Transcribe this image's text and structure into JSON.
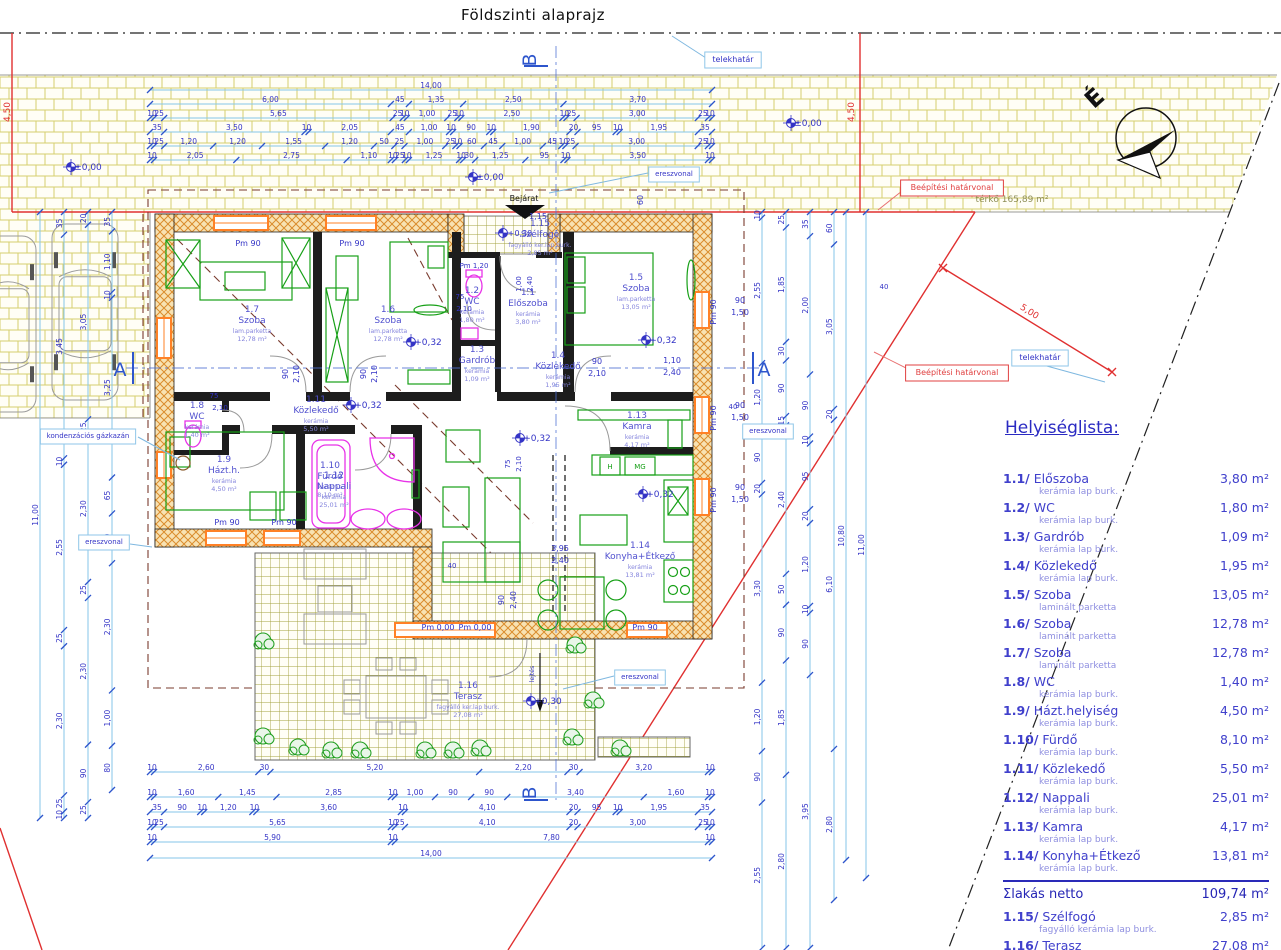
{
  "title": "Földszinti alaprajz",
  "north_label": "É",
  "room_list": {
    "title": "Helyiséglista:",
    "items": [
      {
        "num": "1.1/",
        "name": "Előszoba",
        "area": "3,80 m²",
        "finish": "kerámia lap burk."
      },
      {
        "num": "1.2/",
        "name": "WC",
        "area": "1,80 m²",
        "finish": "kerámia lap burk."
      },
      {
        "num": "1.3/",
        "name": "Gardrób",
        "area": "1,09 m²",
        "finish": "kerámia lap burk."
      },
      {
        "num": "1.4/",
        "name": "Közlekedő",
        "area": "1,95 m²",
        "finish": "kerámia lap burk."
      },
      {
        "num": "1.5/",
        "name": "Szoba",
        "area": "13,05 m²",
        "finish": "laminált parketta"
      },
      {
        "num": "1.6/",
        "name": "Szoba",
        "area": "12,78 m²",
        "finish": "laminált parketta"
      },
      {
        "num": "1.7/",
        "name": "Szoba",
        "area": "12,78 m²",
        "finish": "laminált parketta"
      },
      {
        "num": "1.8/",
        "name": "WC",
        "area": "1,40 m²",
        "finish": "kerámia lap burk."
      },
      {
        "num": "1.9/",
        "name": "Házt.helyiség",
        "area": "4,50 m²",
        "finish": "kerámia lap burk."
      },
      {
        "num": "1.10/",
        "name": "Fürdő",
        "area": "8,10 m²",
        "finish": "kerámia lap burk."
      },
      {
        "num": "1.11/",
        "name": "Közlekedő",
        "area": "5,50 m²",
        "finish": "kerámia lap burk."
      },
      {
        "num": "1.12/",
        "name": "Nappali",
        "area": "25,01 m²",
        "finish": "kerámia lap burk."
      },
      {
        "num": "1.13/",
        "name": "Kamra",
        "area": "4,17 m²",
        "finish": "kerámia lap burk."
      },
      {
        "num": "1.14/",
        "name": "Konyha+Étkező",
        "area": "13,81 m²",
        "finish": "kerámia lap burk."
      }
    ],
    "total": {
      "label": "Σlakás netto",
      "area": "109,74 m²"
    },
    "extra_items": [
      {
        "num": "1.15/",
        "name": "Szélfogó",
        "area": "2,85 m²",
        "finish": "fagyálló kerámia lap burk."
      },
      {
        "num": "1.16/",
        "name": "Terasz",
        "area": "27,08 m²",
        "finish": "fagyálló kerámia lap burk."
      }
    ]
  },
  "rooms": [
    {
      "num": "1.7",
      "name": "Szoba",
      "finish": "lam.parketta",
      "area": "12,78 m²",
      "x": 252,
      "y": 312
    },
    {
      "num": "1.6",
      "name": "Szoba",
      "finish": "lam.parketta",
      "area": "12,78 m²",
      "x": 388,
      "y": 312
    },
    {
      "num": "1.5",
      "name": "Szoba",
      "finish": "lam.parketta",
      "area": "13,05 m²",
      "x": 636,
      "y": 280
    },
    {
      "num": "1.1",
      "name": "Előszoba",
      "finish": "kerámia",
      "area": "3,80 m²",
      "x": 528,
      "y": 295
    },
    {
      "num": "1.2",
      "name": "WC",
      "finish": "kerámia",
      "area": "1,80 m²",
      "x": 472,
      "y": 293
    },
    {
      "num": "1.3",
      "name": "Gardrób",
      "finish": "kerámia",
      "area": "1,09 m²",
      "x": 477,
      "y": 352
    },
    {
      "num": "1.4",
      "name": "Közlekedő",
      "finish": "kerámia",
      "area": "1,95 m²",
      "x": 558,
      "y": 358
    },
    {
      "num": "1.11",
      "name": "Közlekedő",
      "finish": "kerámia",
      "area": "5,50 m²",
      "x": 316,
      "y": 402
    },
    {
      "num": "1.8",
      "name": "WC",
      "finish": "kerámia",
      "area": "1,40 m²",
      "x": 197,
      "y": 408
    },
    {
      "num": "1.9",
      "name": "Házt.h.",
      "finish": "kerámia",
      "area": "4,50 m²",
      "x": 224,
      "y": 462
    },
    {
      "num": "1.10",
      "name": "Fürdő",
      "finish": "kerámia",
      "area": "8,10 m²",
      "x": 330,
      "y": 468
    },
    {
      "num": "1.12",
      "name": "Nappali",
      "finish": "kerámia",
      "area": "25,01 m²",
      "x": 334,
      "y": 478
    },
    {
      "num": "1.13",
      "name": "Kamra",
      "finish": "kerámia",
      "area": "4,17 m²",
      "x": 637,
      "y": 418
    },
    {
      "num": "1.14",
      "name": "Konyha+Étkező",
      "finish": "kerámia",
      "area": "13,81 m²",
      "x": 640,
      "y": 548
    },
    {
      "num": "1.15",
      "name": "Szélfogó",
      "finish": "fagyálló ker.lap burk.",
      "area": "2,85 m²",
      "x": 540,
      "y": 226
    },
    {
      "num": "1.16",
      "name": "Terasz",
      "finish": "fagyálló ker.lap burk.",
      "area": "27,08 m²",
      "x": 468,
      "y": 688
    }
  ],
  "plan_labels": [
    {
      "text": "telekhatár",
      "x": 733,
      "y": 62,
      "box": "blue",
      "size": 8
    },
    {
      "text": "telekhatár",
      "x": 1040,
      "y": 360,
      "box": "blue",
      "size": 8
    },
    {
      "text": "ereszvonal",
      "x": 674,
      "y": 176,
      "box": "blue",
      "size": 7
    },
    {
      "text": "ereszvonal",
      "x": 768,
      "y": 433,
      "box": "blue",
      "size": 7
    },
    {
      "text": "ereszvonal",
      "x": 640,
      "y": 679,
      "box": "blue",
      "size": 7
    },
    {
      "text": "ereszvonal",
      "x": 104,
      "y": 544,
      "box": "blue",
      "size": 7
    },
    {
      "text": "kondenzációs gázkazán",
      "x": 88,
      "y": 438,
      "box": "blue",
      "size": 7
    },
    {
      "text": "Beépítési határvonal",
      "x": 952,
      "y": 190,
      "box": "red",
      "size": 8,
      "color": "#e04040"
    },
    {
      "text": "Beépítési határvonal",
      "x": 957,
      "y": 375,
      "box": "red",
      "size": 8,
      "color": "#e04040"
    },
    {
      "text": "térkő  165,89 m²",
      "x": 1012,
      "y": 202,
      "size": 9,
      "color": "#8e8e55"
    },
    {
      "text": "5,00",
      "x": 1028,
      "y": 314,
      "rot": 32,
      "color": "#e03030",
      "size": 9
    },
    {
      "text": "4,50",
      "x": 10,
      "y": 112,
      "rot": -90,
      "color": "#e03030",
      "size": 9
    },
    {
      "text": "4,50",
      "x": 854,
      "y": 112,
      "rot": -90,
      "color": "#e03030",
      "size": 9
    },
    {
      "text": "±0,00",
      "x": 88,
      "y": 170,
      "size": 9,
      "mark": true
    },
    {
      "text": "±0,00",
      "x": 490,
      "y": 180,
      "size": 9,
      "mark": true
    },
    {
      "text": "±0,00",
      "x": 808,
      "y": 126,
      "size": 9,
      "mark": true
    },
    {
      "text": "+0,32",
      "x": 428,
      "y": 345,
      "size": 9,
      "mark": true
    },
    {
      "text": "+0,32",
      "x": 663,
      "y": 343,
      "size": 9,
      "mark": true
    },
    {
      "text": "+0,32",
      "x": 368,
      "y": 408,
      "size": 9,
      "mark": true
    },
    {
      "text": "+0,32",
      "x": 537,
      "y": 441,
      "size": 9,
      "mark": true
    },
    {
      "text": "+0,32",
      "x": 660,
      "y": 497,
      "size": 9,
      "mark": true
    },
    {
      "text": "+0,30",
      "x": 520,
      "y": 236,
      "size": 8,
      "mark": true
    },
    {
      "text": "+0,30",
      "x": 548,
      "y": 704,
      "size": 9,
      "mark": true
    },
    {
      "text": "Pm 90",
      "x": 248,
      "y": 246,
      "size": 8
    },
    {
      "text": "Pm 90",
      "x": 352,
      "y": 246,
      "size": 8
    },
    {
      "text": "Pm 1,20",
      "x": 474,
      "y": 268,
      "size": 7
    },
    {
      "text": "Pm 90",
      "x": 227,
      "y": 525,
      "size": 8
    },
    {
      "text": "Pm 90",
      "x": 284,
      "y": 525,
      "size": 8
    },
    {
      "text": "Pm 90",
      "x": 645,
      "y": 630,
      "size": 8
    },
    {
      "text": "Pm 0,00",
      "x": 438,
      "y": 630,
      "size": 8
    },
    {
      "text": "Pm 0,00",
      "x": 475,
      "y": 630,
      "size": 8
    },
    {
      "text": "Pm 90",
      "x": 716,
      "y": 312,
      "rot": -90,
      "size": 8
    },
    {
      "text": "Pm 90",
      "x": 716,
      "y": 418,
      "rot": -90,
      "size": 8
    },
    {
      "text": "Pm 90",
      "x": 716,
      "y": 500,
      "rot": -90,
      "size": 8
    },
    {
      "text": "90",
      "x": 740,
      "y": 303,
      "size": 8
    },
    {
      "text": "1,50",
      "x": 740,
      "y": 315,
      "size": 8
    },
    {
      "text": "90",
      "x": 740,
      "y": 408,
      "size": 8
    },
    {
      "text": "1,50",
      "x": 740,
      "y": 420,
      "size": 8
    },
    {
      "text": "90",
      "x": 740,
      "y": 490,
      "size": 8
    },
    {
      "text": "1,50",
      "x": 740,
      "y": 502,
      "size": 8
    },
    {
      "text": "90",
      "x": 288,
      "y": 374,
      "rot": -90,
      "size": 8
    },
    {
      "text": "2,10",
      "x": 299,
      "y": 374,
      "rot": -90,
      "size": 8
    },
    {
      "text": "90",
      "x": 366,
      "y": 374,
      "rot": -90,
      "size": 8
    },
    {
      "text": "2,10",
      "x": 377,
      "y": 374,
      "rot": -90,
      "size": 8
    },
    {
      "text": "90",
      "x": 597,
      "y": 364,
      "size": 8
    },
    {
      "text": "2,10",
      "x": 597,
      "y": 376,
      "size": 8
    },
    {
      "text": "75",
      "x": 214,
      "y": 398,
      "size": 7
    },
    {
      "text": "2,10",
      "x": 220,
      "y": 410,
      "size": 7
    },
    {
      "text": "75",
      "x": 460,
      "y": 299,
      "size": 7
    },
    {
      "text": "2,10",
      "x": 464,
      "y": 311,
      "size": 7
    },
    {
      "text": "75",
      "x": 510,
      "y": 464,
      "rot": -90,
      "size": 7
    },
    {
      "text": "2,10",
      "x": 521,
      "y": 464,
      "rot": -90,
      "size": 7
    },
    {
      "text": "1,10",
      "x": 672,
      "y": 363,
      "size": 8
    },
    {
      "text": "2,40",
      "x": 672,
      "y": 375,
      "size": 8
    },
    {
      "text": "1,00",
      "x": 521,
      "y": 284,
      "rot": -90,
      "size": 7
    },
    {
      "text": "2,40",
      "x": 532,
      "y": 284,
      "rot": -90,
      "size": 7
    },
    {
      "text": "90",
      "x": 504,
      "y": 600,
      "rot": -90,
      "size": 8
    },
    {
      "text": "2,40",
      "x": 516,
      "y": 600,
      "rot": -90,
      "size": 8
    },
    {
      "text": "1,15",
      "x": 538,
      "y": 219,
      "size": 8
    },
    {
      "text": "Bejárat",
      "x": 524,
      "y": 201,
      "size": 8,
      "color": "#111"
    },
    {
      "text": "60",
      "x": 643,
      "y": 200,
      "rot": -90,
      "size": 8
    },
    {
      "text": "40",
      "x": 733,
      "y": 409,
      "size": 7
    },
    {
      "text": "40",
      "x": 884,
      "y": 289,
      "size": 7
    },
    {
      "text": "40",
      "x": 452,
      "y": 568,
      "size": 7
    },
    {
      "text": "H",
      "x": 610,
      "y": 469,
      "size": 7,
      "color": "#17a017"
    },
    {
      "text": "MG",
      "x": 640,
      "y": 469,
      "size": 7,
      "color": "#17a017"
    },
    {
      "text": "3,95",
      "x": 560,
      "y": 551,
      "size": 8
    },
    {
      "text": "2,40",
      "x": 560,
      "y": 563,
      "size": 8
    },
    {
      "text": "lejtés",
      "x": 534,
      "y": 674,
      "rot": -90,
      "size": 6
    }
  ],
  "dims": {
    "top_rows": [
      {
        "y": 90,
        "values": [
          "14,00"
        ]
      },
      {
        "y": 104,
        "values": [
          "6,00",
          "45",
          "1,35",
          "2,50",
          "3,70"
        ]
      },
      {
        "y": 118,
        "values": [
          "10",
          "25",
          "5,65",
          "25",
          "10",
          "1,00",
          "25",
          "10",
          "2,50",
          "10",
          "25",
          "3,00",
          "25",
          "10"
        ]
      },
      {
        "y": 132,
        "values": [
          "35",
          "3,50",
          "10",
          "2,05",
          "45",
          "1,00",
          "10",
          "90",
          "10",
          "1,90",
          "20",
          "95",
          "10",
          "1,95",
          "35"
        ]
      },
      {
        "y": 146,
        "values": [
          "10",
          "25",
          "1,20",
          "1,20",
          "1,55",
          "1,20",
          "50",
          "25",
          "1,00",
          "25",
          "10",
          "60",
          "45",
          "1,00",
          "45",
          "10",
          "25",
          "3,00",
          "25",
          "10"
        ]
      },
      {
        "y": 160,
        "values": [
          "10",
          "2,05",
          "2,75",
          "1,10",
          "10",
          "25",
          "10",
          "1,25",
          "10",
          "30",
          "1,25",
          "95",
          "10",
          "3,50",
          "10"
        ]
      }
    ],
    "bottom_rows": [
      {
        "y": 772,
        "values": [
          "10",
          "2,60",
          "30",
          "5,20",
          "2,20",
          "30",
          "3,20",
          "10"
        ]
      },
      {
        "y": 797,
        "values": [
          "10",
          "1,60",
          "1,45",
          "2,85",
          "10",
          "1,00",
          "90",
          "90",
          "3,40",
          "1,60",
          "10"
        ]
      },
      {
        "y": 812,
        "values": [
          "35",
          "90",
          "10",
          "1,20",
          "10",
          "3,60",
          "10",
          "4,10",
          "20",
          "95",
          "10",
          "1,95",
          "35"
        ]
      },
      {
        "y": 827,
        "values": [
          "10",
          "25",
          "5,65",
          "10",
          "25",
          "4,10",
          "20",
          "3,00",
          "25",
          "10"
        ]
      },
      {
        "y": 842,
        "values": [
          "10",
          "5,90",
          "10",
          "7,80",
          "10"
        ]
      },
      {
        "y": 858,
        "values": [
          "14,00"
        ]
      }
    ],
    "left_cols": [
      {
        "x": 40,
        "from": 212,
        "to": 818,
        "values": [
          "11,00"
        ]
      },
      {
        "x": 64,
        "from": 212,
        "to": 818,
        "values": [
          "35",
          "3,45",
          "10",
          "2,55",
          "25",
          "2,30",
          "25",
          "10"
        ]
      },
      {
        "x": 88,
        "from": 212,
        "to": 818,
        "values": [
          "20",
          "3,05",
          "25",
          "2,30",
          "25",
          "2,30",
          "90",
          "25"
        ]
      },
      {
        "x": 112,
        "from": 212,
        "to": 790,
        "values": [
          "35",
          "1,10",
          "10",
          "3,25",
          "65",
          "90",
          "2,30",
          "1,00",
          "80"
        ]
      }
    ],
    "right_cols": [
      {
        "x": 762,
        "from": 212,
        "to": 948,
        "values": [
          "10",
          "2,55",
          "1,20",
          "90",
          "20",
          "3,30",
          "1,20",
          "90",
          "2,55"
        ]
      },
      {
        "x": 786,
        "from": 212,
        "to": 948,
        "values": [
          "25",
          "1,85",
          "30",
          "90",
          "15",
          "2,40",
          "50",
          "90",
          "1,85",
          "2,80"
        ]
      },
      {
        "x": 810,
        "from": 212,
        "to": 948,
        "values": [
          "35",
          "2,00",
          "90",
          "10",
          "95",
          "20",
          "1,20",
          "10",
          "90",
          "3,95"
        ]
      },
      {
        "x": 834,
        "from": 212,
        "to": 900,
        "values": [
          "60",
          "3,05",
          "20",
          "6,10",
          "2,80"
        ]
      },
      {
        "x": 846,
        "from": 212,
        "to": 860,
        "values": [
          "10,80"
        ]
      },
      {
        "x": 866,
        "from": 212,
        "to": 878,
        "values": [
          "11,00"
        ]
      }
    ]
  },
  "section_markers": {
    "a": "A",
    "b": "B"
  }
}
